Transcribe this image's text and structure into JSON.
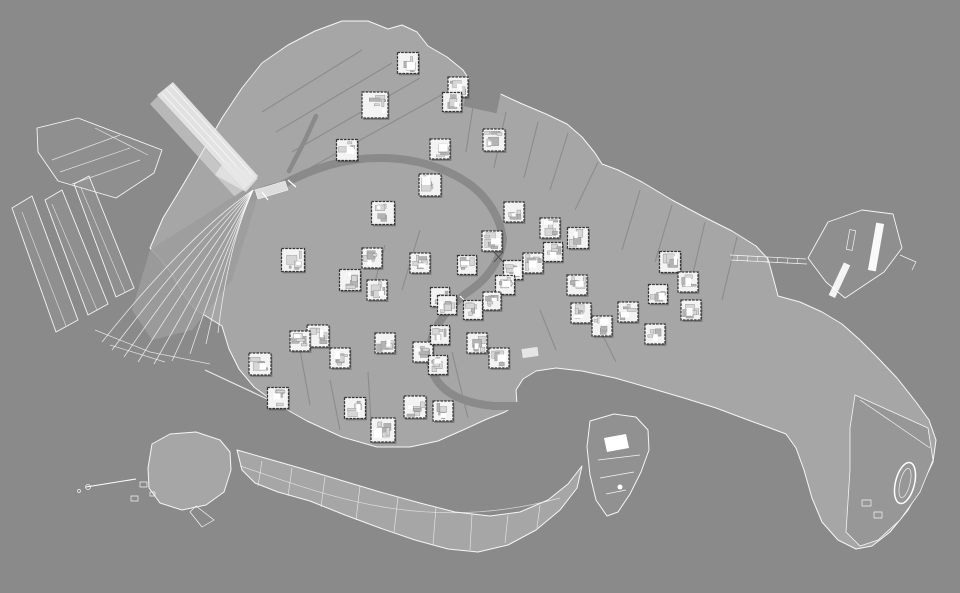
{
  "canvas": {
    "width": 960,
    "height": 593
  },
  "colors": {
    "background": "#8a8a8a",
    "land_base": "#a6a6a6",
    "land_block": "#b6b6b6",
    "land_line": "#ffffff",
    "outline": "#f6f6f6",
    "water": "#8a8a8a",
    "marker_fill": "#f3f3f3",
    "marker_border": "#333333",
    "marker_detail": "#b3b3b3",
    "railway": "#e6e6e6"
  },
  "map": {
    "kind": "figure-ground city map (white linework on gray)",
    "city_shape": "Venice, Italy",
    "marker_format": "[x, y, size_px]",
    "marker_count": 51,
    "markers": [
      [
        408,
        63,
        21
      ],
      [
        458,
        87,
        20
      ],
      [
        452,
        102,
        19
      ],
      [
        375,
        105,
        26
      ],
      [
        494,
        140,
        22
      ],
      [
        347,
        150,
        21
      ],
      [
        440,
        149,
        20
      ],
      [
        430,
        185,
        22
      ],
      [
        383,
        213,
        23
      ],
      [
        514,
        212,
        20
      ],
      [
        550,
        228,
        20
      ],
      [
        578,
        238,
        21
      ],
      [
        492,
        241,
        20
      ],
      [
        293,
        260,
        23
      ],
      [
        372,
        258,
        20
      ],
      [
        420,
        263,
        20
      ],
      [
        467,
        265,
        19
      ],
      [
        350,
        280,
        21
      ],
      [
        513,
        270,
        19
      ],
      [
        533,
        263,
        20
      ],
      [
        553,
        252,
        19
      ],
      [
        577,
        285,
        20
      ],
      [
        670,
        262,
        21
      ],
      [
        688,
        282,
        20
      ],
      [
        658,
        294,
        19
      ],
      [
        505,
        285,
        19
      ],
      [
        377,
        290,
        20
      ],
      [
        440,
        297,
        19
      ],
      [
        447,
        305,
        19
      ],
      [
        473,
        310,
        19
      ],
      [
        492,
        301,
        18
      ],
      [
        318,
        336,
        22
      ],
      [
        300,
        341,
        20
      ],
      [
        340,
        358,
        20
      ],
      [
        260,
        364,
        22
      ],
      [
        278,
        398,
        21
      ],
      [
        355,
        408,
        21
      ],
      [
        383,
        430,
        24
      ],
      [
        415,
        407,
        22
      ],
      [
        443,
        411,
        20
      ],
      [
        385,
        343,
        20
      ],
      [
        423,
        352,
        20
      ],
      [
        440,
        335,
        19
      ],
      [
        438,
        365,
        19
      ],
      [
        477,
        343,
        20
      ],
      [
        499,
        358,
        20
      ],
      [
        581,
        313,
        20
      ],
      [
        602,
        326,
        20
      ],
      [
        628,
        312,
        20
      ],
      [
        655,
        334,
        20
      ],
      [
        691,
        310,
        20
      ]
    ]
  }
}
